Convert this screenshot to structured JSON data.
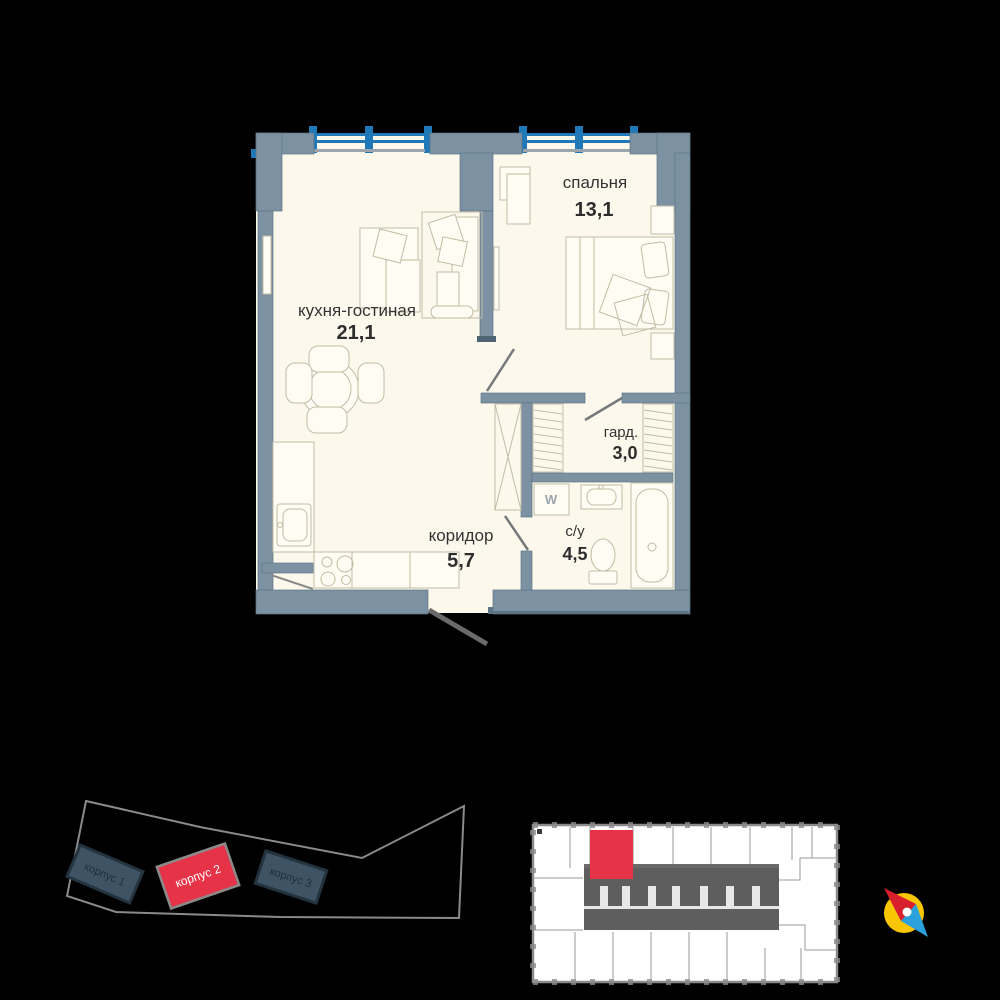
{
  "colors": {
    "background": "#000000",
    "wall": "#7C92A2",
    "floor": "#FCF9EC",
    "window_blue": "#1F78B8",
    "accent_red": "#E73347",
    "building_dark": "#3E5465",
    "outline_gray": "#8A8A8A",
    "text_dark": "#333333"
  },
  "apartment": {
    "rooms": [
      {
        "name": "кухня-гостиная",
        "area": "21,1"
      },
      {
        "name": "спальня",
        "area": "13,1"
      },
      {
        "name": "гард.",
        "area": "3,0"
      },
      {
        "name": "коридор",
        "area": "5,7"
      },
      {
        "name": "с/у",
        "area": "4,5"
      }
    ],
    "washer_label": "W"
  },
  "site_plan": {
    "buildings": [
      {
        "label": "корпус 1",
        "highlighted": false
      },
      {
        "label": "корпус 2",
        "highlighted": true
      },
      {
        "label": "корпус 3",
        "highlighted": false
      }
    ]
  },
  "icons": {
    "compass": "compass-needle"
  }
}
